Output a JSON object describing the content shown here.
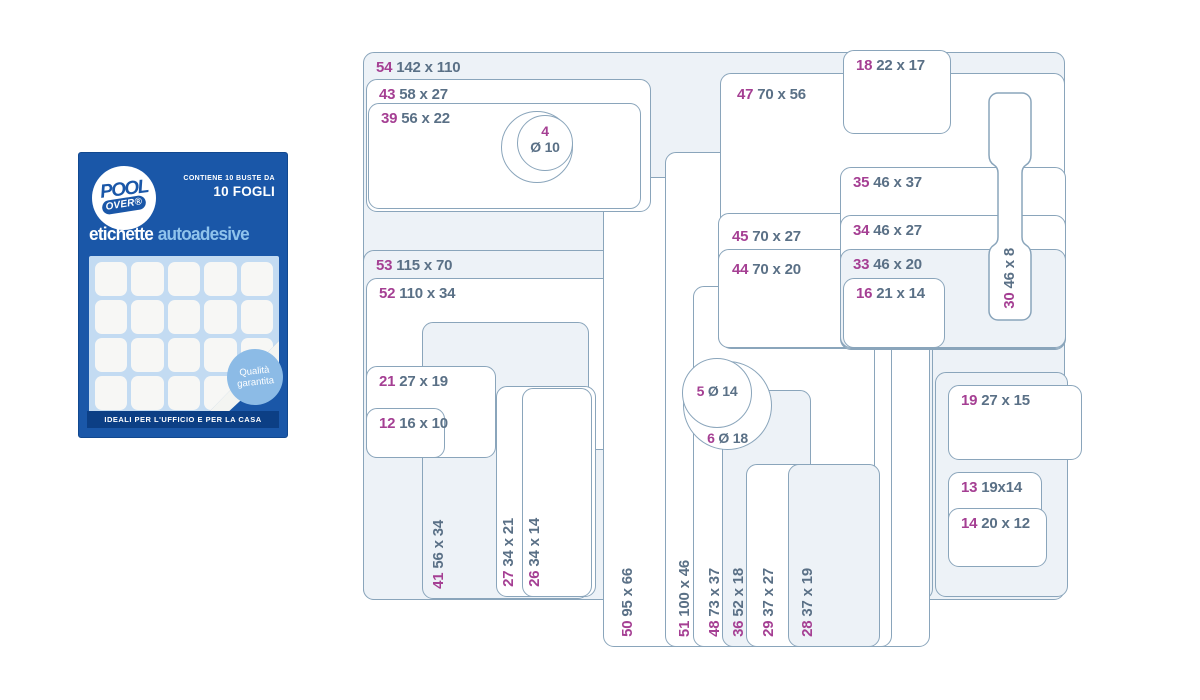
{
  "package": {
    "brand": {
      "word1": "POOL",
      "word2": "OVER®"
    },
    "contains_line1": "CONTIENE 10 BUSTE DA",
    "contains_line2": "10 FOGLI",
    "title": {
      "white": "etichette",
      "light": "autoadesive"
    },
    "badge": {
      "line1": "Qualità",
      "line2": "garantita"
    },
    "footer": "IDEALI PER L'UFFICIO E PER LA CASA",
    "colors": {
      "blue": "#1a57a8",
      "footer_blue": "#0c3f85",
      "title_light": "#8fc3ec",
      "badge": "#8cbbe6",
      "sheet": "#c3dbf2"
    }
  },
  "diagram": {
    "colors": {
      "border": "#8aa5bb",
      "panel": "#edf2f7",
      "white": "#ffffff",
      "code": "#a53f93",
      "dims": "#5a7086"
    },
    "shapes": [
      {
        "code": "54",
        "dims": "142 x 110",
        "box": [
          363,
          52,
          702,
          548
        ],
        "fill": "panel",
        "label": "tl"
      },
      {
        "code": "53",
        "dims": "115 x 70",
        "box": [
          363,
          250,
          570,
          350
        ],
        "fill": "panel",
        "label": "tl"
      },
      {
        "code": "52",
        "dims": "110 x 34",
        "box": [
          366,
          278,
          546,
          172
        ],
        "fill": "white",
        "label": "tl"
      },
      {
        "code": "50",
        "dims": "95 x 66",
        "box": [
          603,
          177,
          327,
          470
        ],
        "fill": "white",
        "label": "vert",
        "lx": 617
      },
      {
        "code": "51",
        "dims": "100 x 46",
        "box": [
          665,
          152,
          227,
          495
        ],
        "fill": "white",
        "label": "vert",
        "lx": 674
      },
      {
        "code": "41",
        "dims": "56 x 34",
        "box": [
          422,
          322,
          167,
          277
        ],
        "fill": "panel",
        "label": "vert",
        "lx": 428
      },
      {
        "code": "27",
        "dims": "34 x 21",
        "box": [
          496,
          386,
          100,
          211
        ],
        "fill": "white",
        "label": "vert",
        "lx": 498
      },
      {
        "code": "26",
        "dims": "34 x 14",
        "box": [
          522,
          388,
          70,
          209
        ],
        "fill": "white",
        "label": "vert",
        "lx": 524
      },
      {
        "code": "21",
        "dims": "27 x 19",
        "box": [
          366,
          366,
          130,
          92
        ],
        "fill": "white",
        "label": "tl"
      },
      {
        "code": "12",
        "dims": "16 x 10",
        "box": [
          366,
          408,
          79,
          50
        ],
        "fill": "white",
        "label": "tl"
      },
      {
        "code": "43",
        "dims": "58 x 27",
        "box": [
          366,
          79,
          285,
          133
        ],
        "fill": "white",
        "label": "tl"
      },
      {
        "code": "39",
        "dims": "56 x 22",
        "box": [
          368,
          103,
          273,
          106
        ],
        "fill": "white",
        "label": "tl"
      },
      {
        "dims": "",
        "box": [
          501,
          111,
          72,
          72
        ],
        "fill": "white",
        "type": "circle"
      },
      {
        "code": "4",
        "dims": "Ø 10",
        "box": [
          517,
          115,
          56,
          56
        ],
        "fill": "white",
        "type": "circle",
        "label": "c2"
      },
      {
        "code": "48",
        "dims": "73 x 37",
        "box": [
          693,
          286,
          182,
          361
        ],
        "fill": "white",
        "label": "vert",
        "lx": 704
      },
      {
        "code": "36",
        "dims": "52 x 18",
        "box": [
          722,
          390,
          89,
          257
        ],
        "fill": "panel",
        "label": "vert",
        "lx": 728
      },
      {
        "code": "29",
        "dims": "37 x 27",
        "box": [
          746,
          464,
          133,
          183
        ],
        "fill": "white",
        "label": "vert",
        "lx": 758
      },
      {
        "code": "28",
        "dims": "37 x 19",
        "box": [
          788,
          464,
          92,
          183
        ],
        "fill": "panel",
        "label": "vert",
        "lx": 797
      },
      {
        "code": "47",
        "dims": "70 x 56",
        "box": [
          720,
          73,
          345,
          276
        ],
        "fill": "white",
        "label": "tl",
        "lo": [
          16,
          12
        ]
      },
      {
        "code": "45",
        "dims": "70 x 27",
        "box": [
          718,
          213,
          347,
          135
        ],
        "fill": "white",
        "label": "tl",
        "lo": [
          13,
          14
        ]
      },
      {
        "code": "44",
        "dims": "70 x 20",
        "box": [
          718,
          249,
          347,
          99
        ],
        "fill": "white",
        "label": "tl",
        "lo": [
          13,
          11
        ]
      },
      {
        "code": "35",
        "dims": "46 x 37",
        "box": [
          840,
          167,
          226,
          183
        ],
        "fill": "white",
        "label": "tl"
      },
      {
        "code": "34",
        "dims": "46 x 27",
        "box": [
          840,
          215,
          226,
          134
        ],
        "fill": "white",
        "label": "tl"
      },
      {
        "code": "33",
        "dims": "46 x 20",
        "box": [
          840,
          249,
          226,
          99
        ],
        "fill": "panel",
        "label": "tl"
      },
      {
        "code": "16",
        "dims": "21 x 14",
        "box": [
          843,
          278,
          102,
          70
        ],
        "fill": "white",
        "label": "tl"
      },
      {
        "code": "18",
        "dims": "22 x 17",
        "box": [
          843,
          50,
          108,
          84
        ],
        "fill": "white",
        "label": "tl"
      },
      {
        "code": "30",
        "dims": "46 x 8",
        "box": [
          988,
          92,
          44,
          229
        ],
        "fill": "white",
        "type": "tag",
        "label": "vert",
        "lx": 1000
      },
      {
        "code": "6",
        "dims": "Ø 18",
        "box": [
          683,
          361,
          89,
          89
        ],
        "fill": "white",
        "type": "circle",
        "label": "b"
      },
      {
        "code": "5",
        "dims": "Ø 14",
        "box": [
          682,
          358,
          70,
          70
        ],
        "fill": "white",
        "type": "circle",
        "label": "c1"
      },
      {
        "dims": "",
        "box": [
          935,
          372,
          133,
          225
        ],
        "fill": "panel",
        "type": "panel"
      },
      {
        "code": "19",
        "dims": "27 x 15",
        "box": [
          948,
          385,
          134,
          75
        ],
        "fill": "white",
        "label": "tl"
      },
      {
        "code": "13",
        "dims": "19x14",
        "box": [
          948,
          472,
          94,
          70
        ],
        "fill": "white",
        "label": "tl"
      },
      {
        "code": "14",
        "dims": "20 x 12",
        "box": [
          948,
          508,
          99,
          59
        ],
        "fill": "white",
        "label": "tl"
      }
    ]
  }
}
